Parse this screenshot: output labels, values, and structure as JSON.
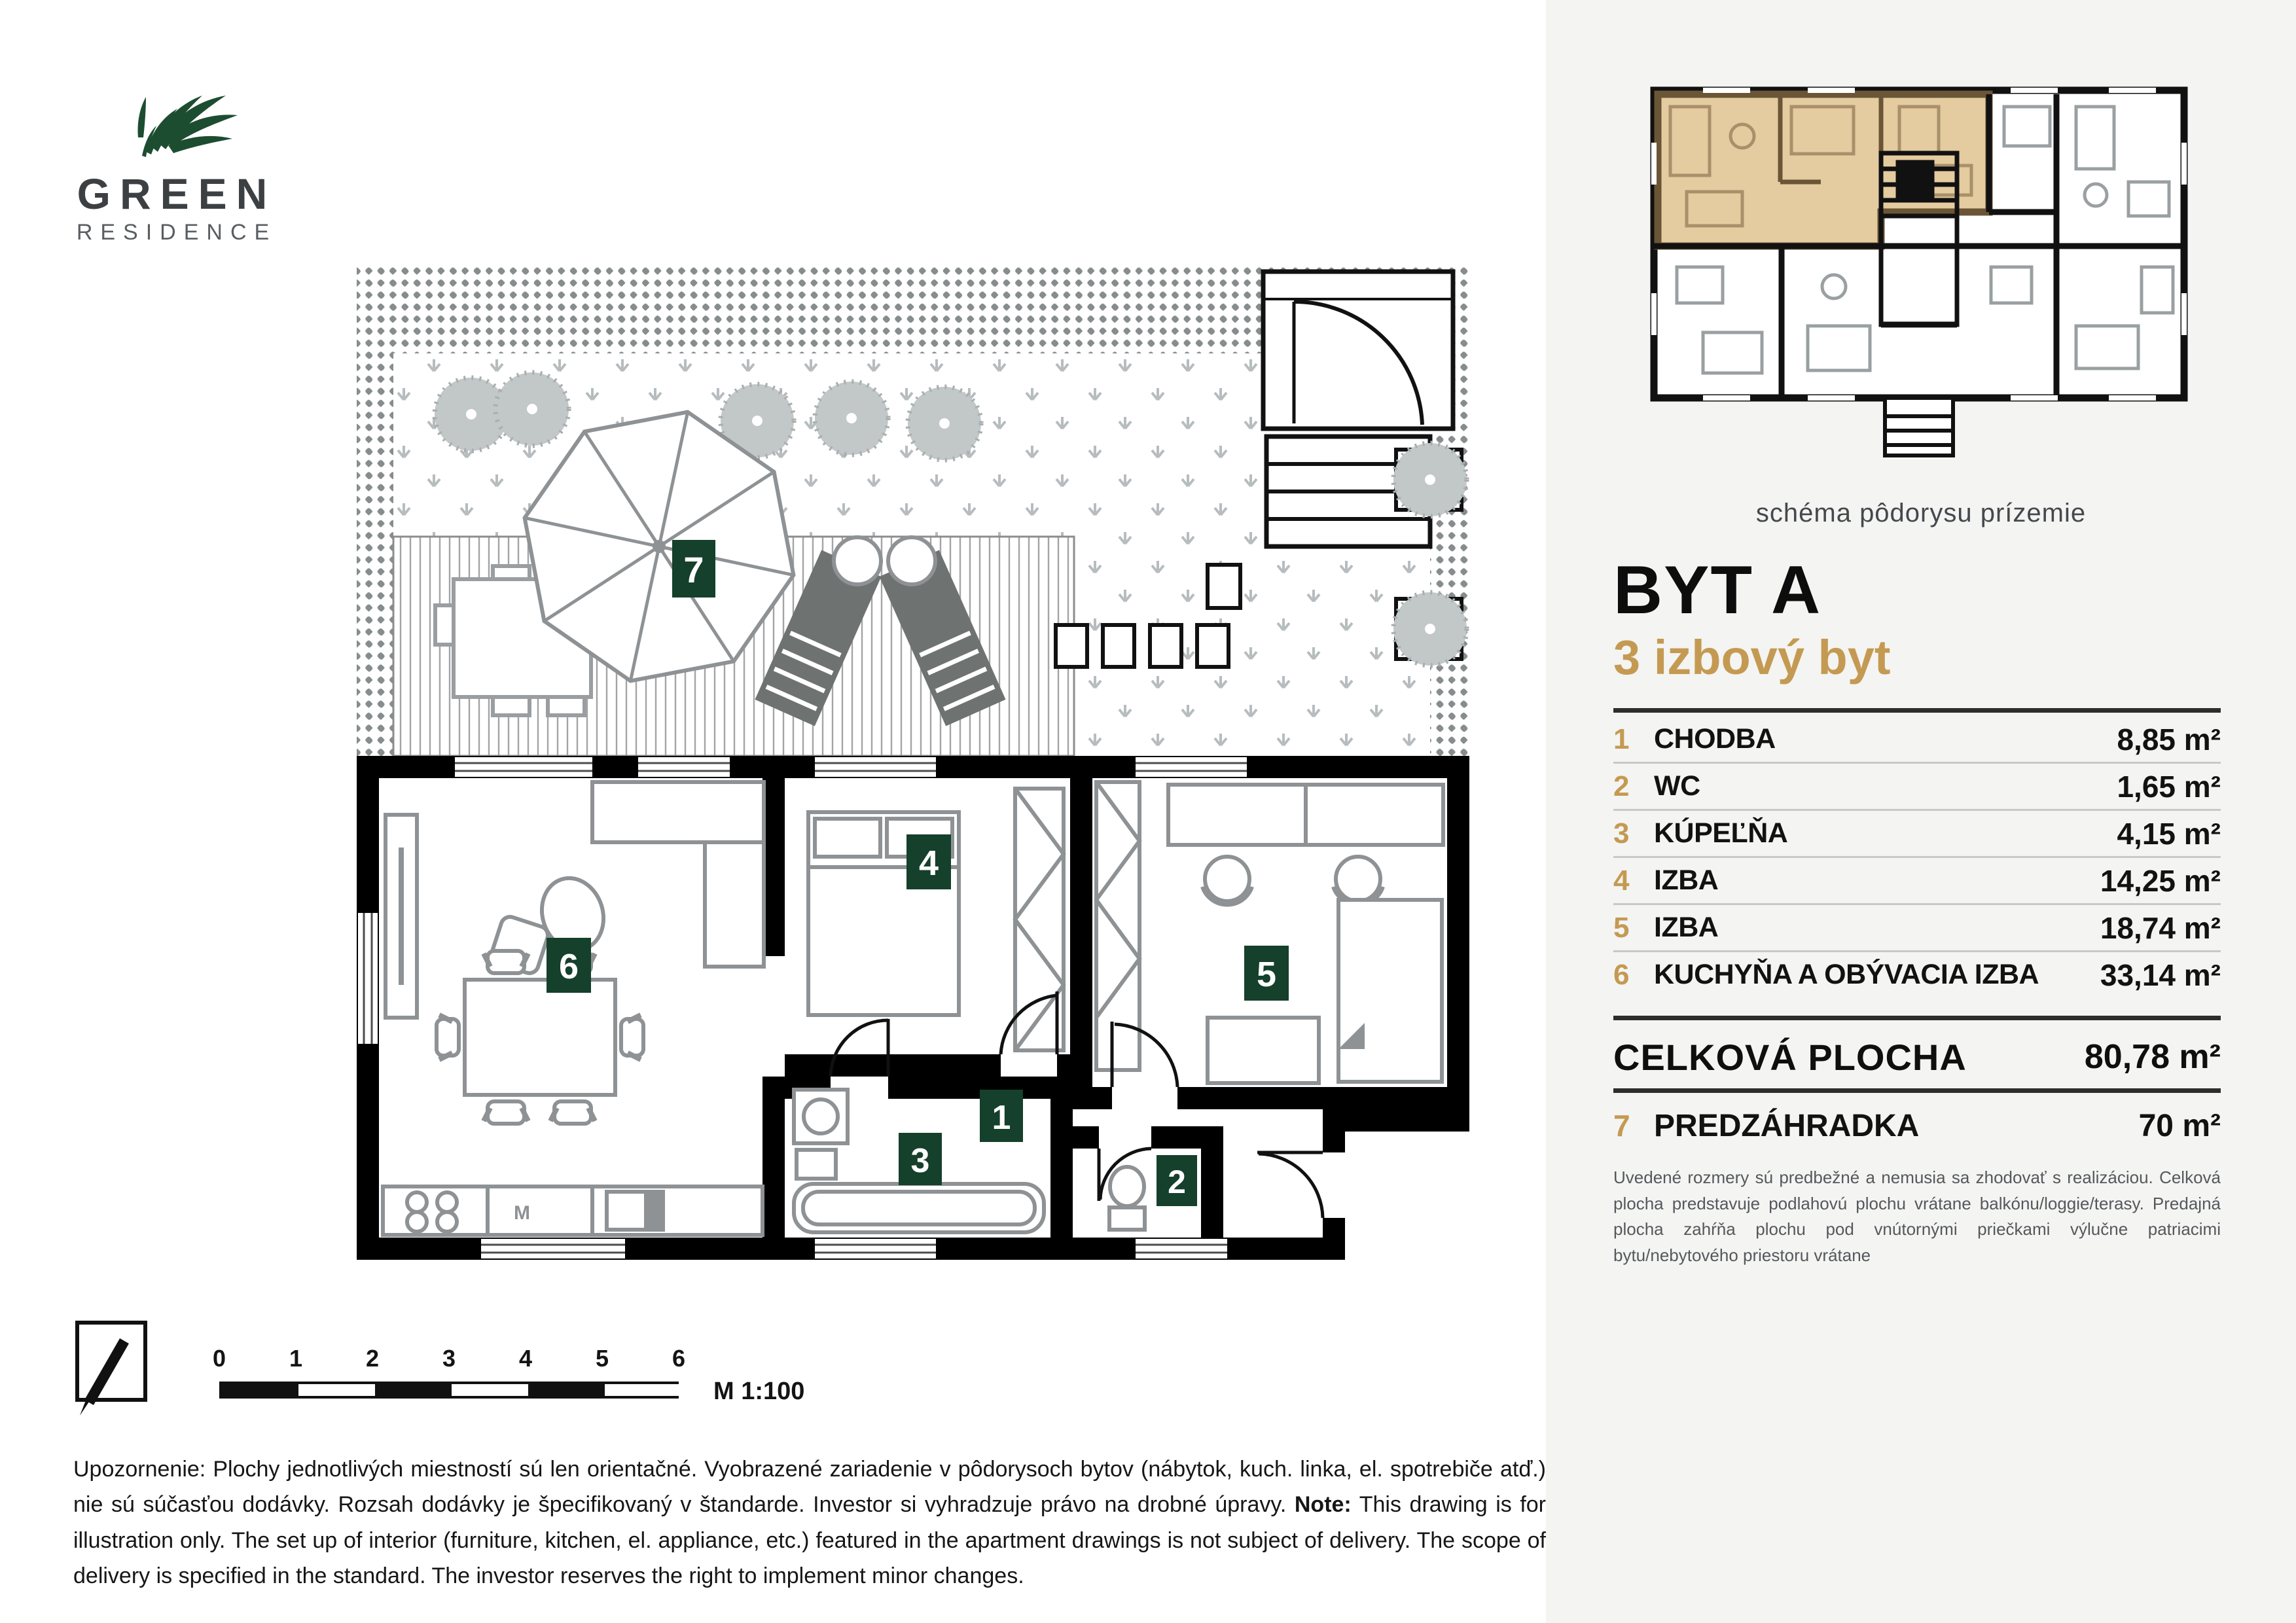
{
  "logo": {
    "brand_top": "GREEN",
    "brand_bottom": "RESIDENCE"
  },
  "schema": {
    "caption": "schéma pôdorysu prízemie"
  },
  "unit": {
    "title": "BYT A",
    "subtitle": "3 izbový byt"
  },
  "rooms": [
    {
      "num": "1",
      "label": "CHODBA",
      "area": "8,85 m²"
    },
    {
      "num": "2",
      "label": "WC",
      "area": "1,65 m²"
    },
    {
      "num": "3",
      "label": "KÚPEĽŇA",
      "area": "4,15 m²"
    },
    {
      "num": "4",
      "label": "IZBA",
      "area": "14,25 m²"
    },
    {
      "num": "5",
      "label": "IZBA",
      "area": "18,74 m²"
    },
    {
      "num": "6",
      "label": "KUCHYŇA A OBÝVACIA IZBA",
      "area": "33,14 m²"
    }
  ],
  "total": {
    "label": "CELKOVÁ PLOCHA",
    "area": "80,78 m²"
  },
  "garden": {
    "num": "7",
    "label": "PREDZÁHRADKA",
    "area": "70 m²"
  },
  "right_note": "Uvedené rozmery sú predbežné a nemusia sa zhodovať s realizáciou. Celková plocha predstavuje podlahovú plochu vrátane balkónu/loggie/terasy. Predajná plocha zahŕňa plochu pod vnútornými priečkami výlučne patriacimi bytu/nebytového priestoru vrátane",
  "plan": {
    "badges": [
      "1",
      "2",
      "3",
      "4",
      "5",
      "6",
      "7"
    ],
    "kitchen_label": "M"
  },
  "scalebar": {
    "ticks": [
      "0",
      "1",
      "2",
      "3",
      "4",
      "5",
      "6"
    ],
    "scale_label": "M 1:100"
  },
  "bottom_disclaimer": {
    "sk_lead": "Upozornenie:",
    "sk_text": " Plochy jednotlivých miestností sú len orientačné. Vyobrazené zariadenie v pôdorysoch bytov (nábytok, kuch. linka, el. spotrebiče atď.) nie sú súčasťou dodávky. Rozsah dodávky je špecifikovaný v štandarde. Investor si vyhradzuje právo na drobné úpravy. ",
    "en_lead": "Note:",
    "en_text": " This drawing is for illustration only. The set up of interior (furniture, kitchen, el. appliance, etc.) featured in the apartment drawings is not subject of delivery. The scope of delivery is specified in the standard. The investor reserves the right to implement minor changes."
  },
  "colors": {
    "accent_gold": "#c49a52",
    "badge_green": "#15402b",
    "logo_green": "#1d4d31",
    "schema_highlight": "#e4cba0",
    "schema_wall_brown": "#6a5636",
    "panel_bg": "#f4f4f2"
  }
}
